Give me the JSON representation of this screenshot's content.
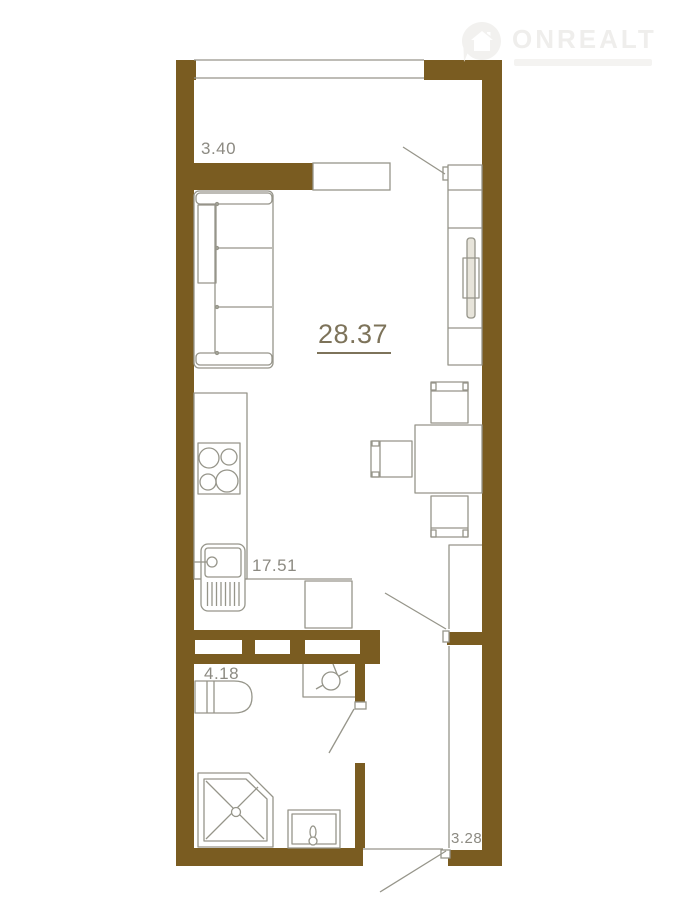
{
  "logo": {
    "brand": "ONREALT",
    "tagline": ""
  },
  "rooms": {
    "total": {
      "area": "28.37"
    },
    "living": {
      "area": "17.51"
    },
    "balcony": {
      "area": "3.40"
    },
    "bathroom": {
      "area": "4.18"
    },
    "hallway": {
      "area": "3.28"
    }
  },
  "colors": {
    "wall": "#7a5c21",
    "line": "#96958a",
    "label": "#8c8a82",
    "total_label": "#7d735a",
    "logo": "#efeeec",
    "logo_icon": "#f2f1ef"
  }
}
